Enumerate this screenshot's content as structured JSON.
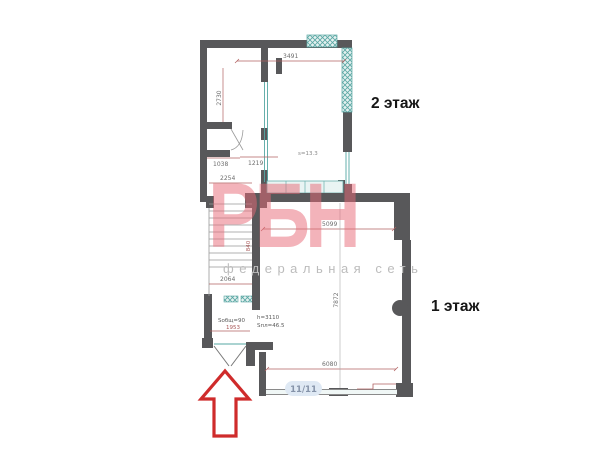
{
  "labels": {
    "floor2": "2 этаж",
    "floor1": "1 этаж"
  },
  "watermark": {
    "logo": "РБН",
    "tagline": "федеральная сеть"
  },
  "window_badge": "11/11",
  "dimensions": {
    "top": "3491",
    "left_vertical": "2730",
    "wc_width_left": "1038",
    "wc_width_right": "1219",
    "stairs_top": "2254",
    "stairs_bottom": "2064",
    "stairs_side": "840",
    "entry_width": "1953",
    "room1_top": "5099",
    "room1_right_vertical": "7872",
    "room1_bottom": "6080"
  },
  "room_info": {
    "entry_area": "Sобщ=90",
    "hall_height": "h=3110",
    "hall_area": "Sпл=46.5",
    "floor2_area": "s=13.3"
  },
  "colors": {
    "wall": "#58585a",
    "thin_line": "#979797",
    "dimension_line": "#b06060",
    "glazing": "#55a7a3",
    "watermark_pink": "#e76875",
    "tagline_gray": "#bcbcbc",
    "arrow_red": "#cf2b2b",
    "badge_bg": "#dfe9f4",
    "badge_text": "#8593a9"
  }
}
